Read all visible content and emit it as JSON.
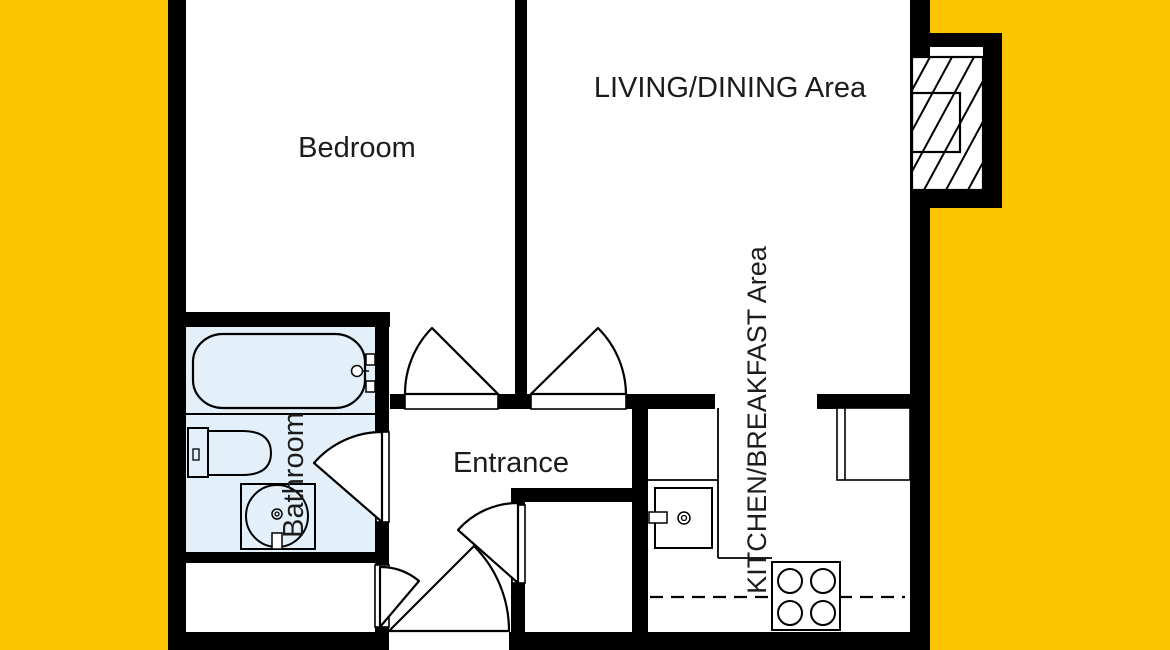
{
  "rooms": {
    "bedroom": {
      "label": "Bedroom"
    },
    "living_dining": {
      "label": "LIVING/DINING Area"
    },
    "entrance": {
      "label": "Entrance"
    },
    "bathroom": {
      "label": "Bathroom"
    },
    "kitchen_breakfast": {
      "label": "KITCHEN/BREAKFAST Area"
    }
  },
  "colors": {
    "background": "#FCC500",
    "interior": "#FFFFFF",
    "walls": "#000000",
    "bathroom_floor": "#E3F0FA",
    "label_text": "#1C1C1C"
  },
  "fixtures": {
    "bathtub": "bathtub",
    "toilet": "toilet",
    "bathroom_sink": "washbasin",
    "kitchen_sink": "kitchen sink",
    "stove": "4-burner stove",
    "counter": "kitchen counter",
    "table": "breakfast table",
    "chimney": "chimney / flue (hatched)"
  }
}
